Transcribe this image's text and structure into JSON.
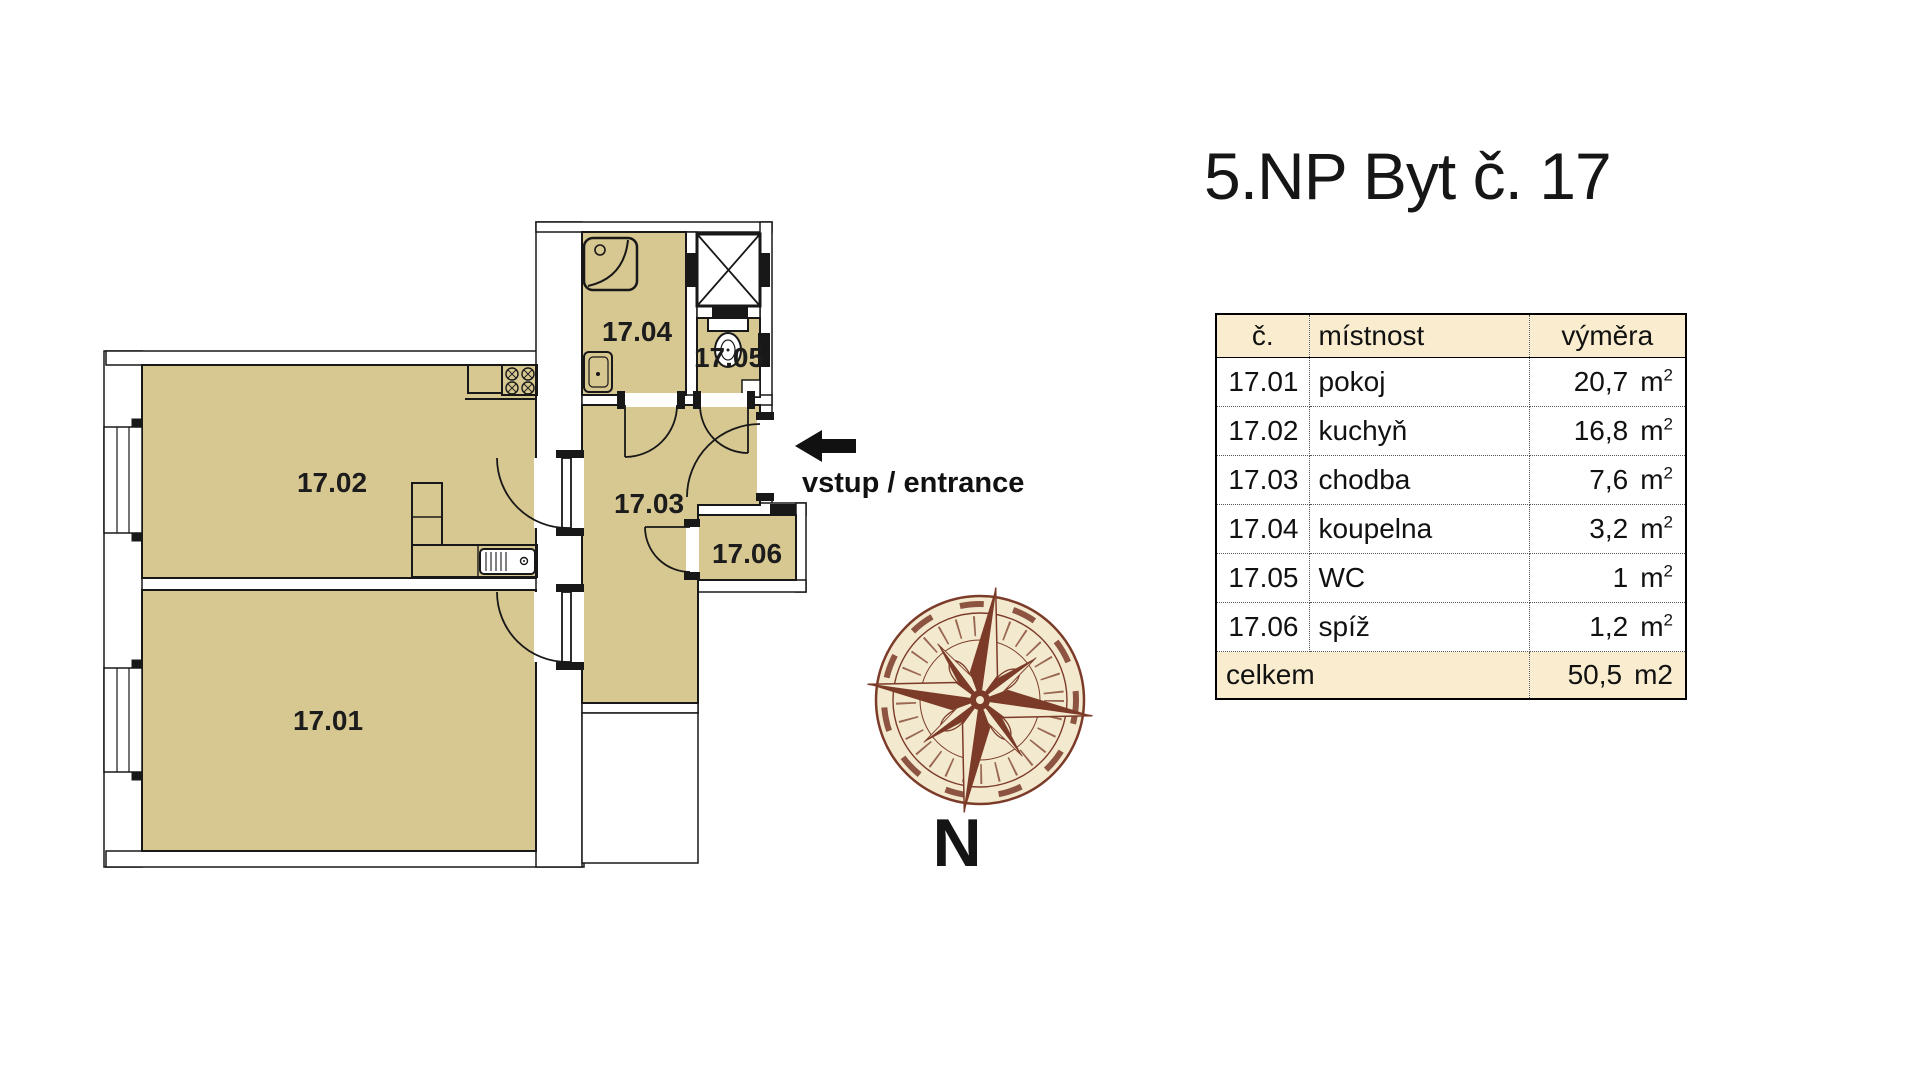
{
  "page": {
    "title": "5.NP Byt č. 17"
  },
  "floor_plan": {
    "room_labels": {
      "r1701": "17.01",
      "r1702": "17.02",
      "r1703": "17.03",
      "r1704": "17.04",
      "r1705": "17.05",
      "r1706": "17.06"
    },
    "entrance_label": "vstup / entrance",
    "compass": {
      "north_label": "N"
    },
    "colors": {
      "room_fill": "#D7C791",
      "wall_line": "#181818",
      "compass_ink": "#7B3B28",
      "compass_paper": "#F2E9CE"
    }
  },
  "area_table": {
    "headers": {
      "number": "č.",
      "room": "místnost",
      "area": "výměra"
    },
    "rows": [
      {
        "number": "17.01",
        "room": "pokoj",
        "area": "20,7",
        "unit": "m",
        "unit_exp": "2"
      },
      {
        "number": "17.02",
        "room": "kuchyň",
        "area": "16,8",
        "unit": "m",
        "unit_exp": "2"
      },
      {
        "number": "17.03",
        "room": "chodba",
        "area": "7,6",
        "unit": "m",
        "unit_exp": "2"
      },
      {
        "number": "17.04",
        "room": "koupelna",
        "area": "3,2",
        "unit": "m",
        "unit_exp": "2"
      },
      {
        "number": "17.05",
        "room": "WC",
        "area": "1",
        "unit": "m",
        "unit_exp": "2"
      },
      {
        "number": "17.06",
        "room": "spíž",
        "area": "1,2",
        "unit": "m",
        "unit_exp": "2"
      }
    ],
    "total": {
      "label": "celkem",
      "area": "50,5",
      "unit": "m2"
    },
    "colors": {
      "highlight_bg": "#FAEDCF"
    }
  }
}
